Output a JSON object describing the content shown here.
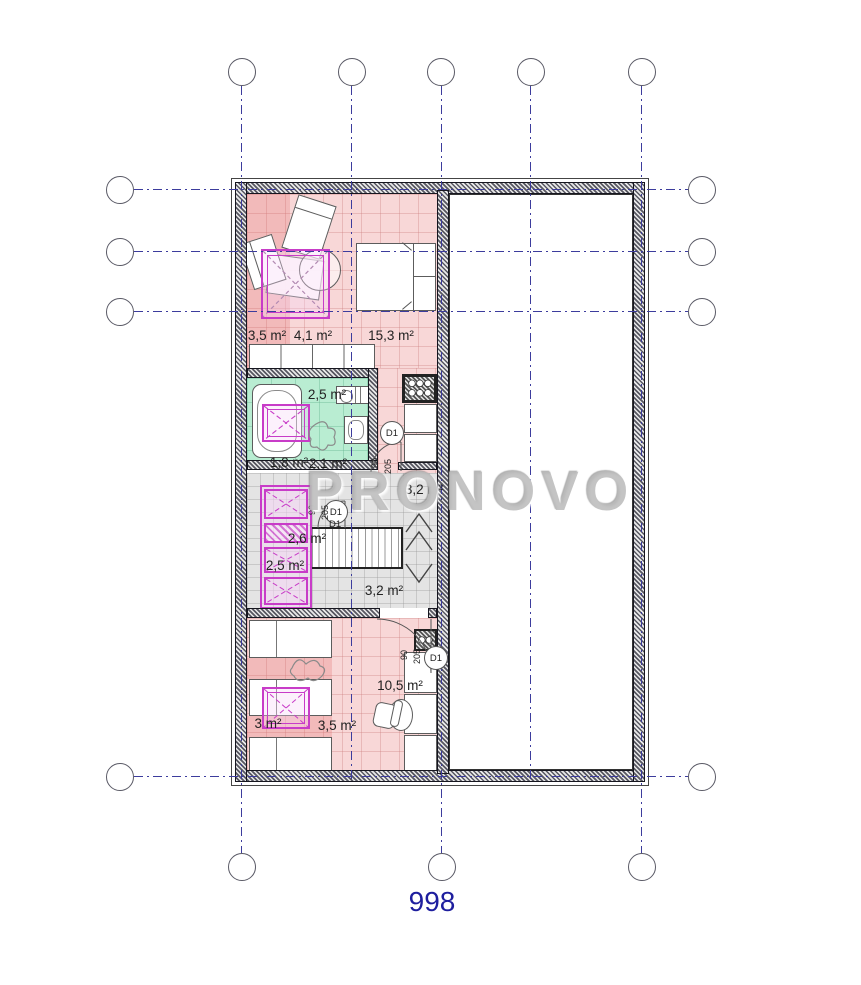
{
  "sheet": {
    "number": "998",
    "watermark": "PRONOVO"
  },
  "door": {
    "tag": "D1",
    "width": "90",
    "height": "205"
  },
  "areas": {
    "top_room": [
      "3,5 m²",
      "4,1 m²",
      "15,3 m²"
    ],
    "bathroom": [
      "2,5 m²",
      "1,8 m²",
      "2,1 m²"
    ],
    "hall": [
      "3,2 m²",
      "2,6 m²",
      "2,5 m²",
      "3,2 m²"
    ],
    "bedroom": [
      "3 m²",
      "3,5 m²",
      "10,5 m²"
    ]
  },
  "colors": {
    "floor_pink": "#f8d7d7",
    "floor_pink_dark": "#f0aaaa",
    "floor_green": "#b9edd2",
    "floor_gray": "#e4e4e4",
    "accent_magenta": "#c83cc8",
    "grid_blue": "#3c3c9d",
    "sheet_number_blue": "#1e1e9e",
    "watermark_gray": "#bababa"
  }
}
